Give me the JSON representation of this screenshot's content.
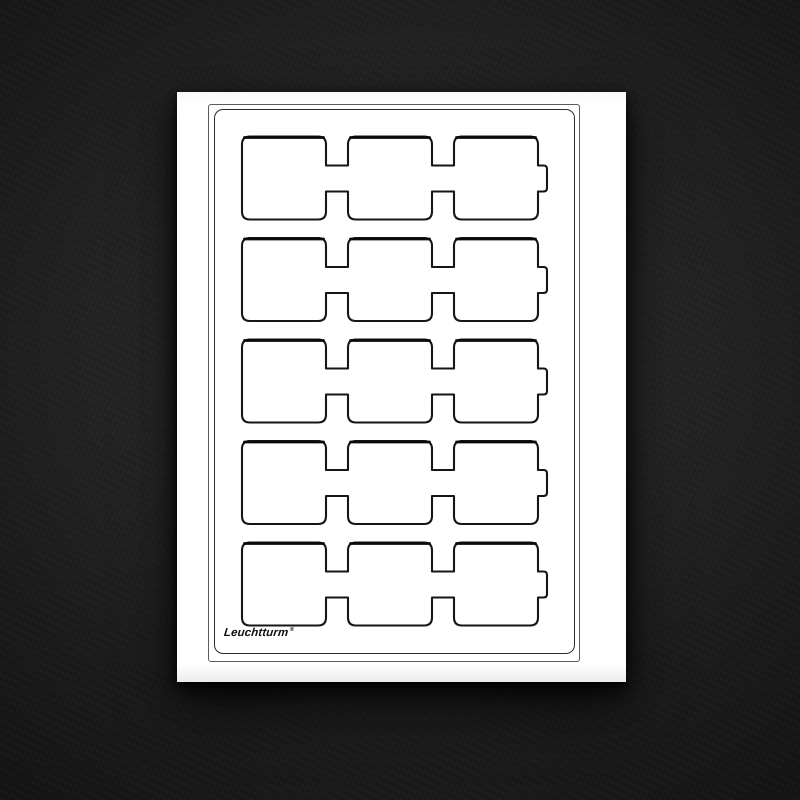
{
  "colors": {
    "backdrop_center": "#2d2d2d",
    "backdrop_edge": "#131313",
    "card": "#ffffff",
    "outer_frame_line": "#5a5a5a",
    "inner_frame_line": "#2c2c2c",
    "pocket_outline": "#161616",
    "pocket_top_shadow": "#0a0a0a",
    "logo": "#101010"
  },
  "tray": {
    "rows": 5,
    "pockets_per_row": 3,
    "pockets_total": 15,
    "right_edge_finger_tab_per_row": true,
    "brand": {
      "label": "Leuchtturm",
      "registered_mark": "®"
    }
  }
}
